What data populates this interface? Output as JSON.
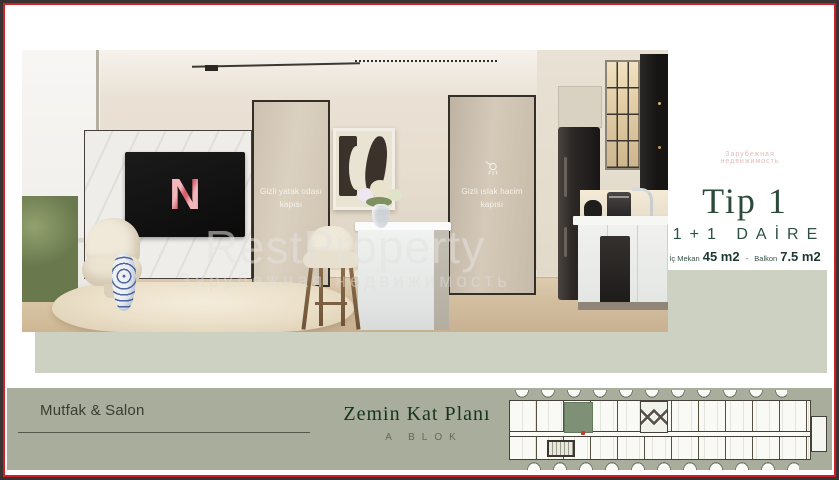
{
  "colors": {
    "frame_red": "#ce2127",
    "frame_dark": "#3a3233",
    "accent_green": "#2c4a3a",
    "footer_bg": "#a9ad9b",
    "band_bg": "#cdd1c1",
    "plan_highlight_unit": "#7e9177",
    "tv_logo_pink": "#efa3ab"
  },
  "hero": {
    "door_bedroom": {
      "line1": "Gizli yatak odası",
      "line2": "kapısı"
    },
    "door_wet": {
      "line1": "Gizli ıslak hacim",
      "line2": "kapısı"
    },
    "tv_logo": "N",
    "watermark": {
      "title": "RestProperty",
      "subtitle": "Зарубежная недвижимость"
    }
  },
  "info": {
    "type_title": "Tip 1",
    "apartment_type": "1+1 DAİRE",
    "interior_label": "İç Mekan",
    "interior_value": "45 m2",
    "separator": "-",
    "balcony_label": "Balkon",
    "balcony_value": "7.5 m2"
  },
  "footer": {
    "room_label": "Mutfak & Salon",
    "plan_title": "Zemin Kat Planı",
    "block_label": "A BLOK"
  }
}
